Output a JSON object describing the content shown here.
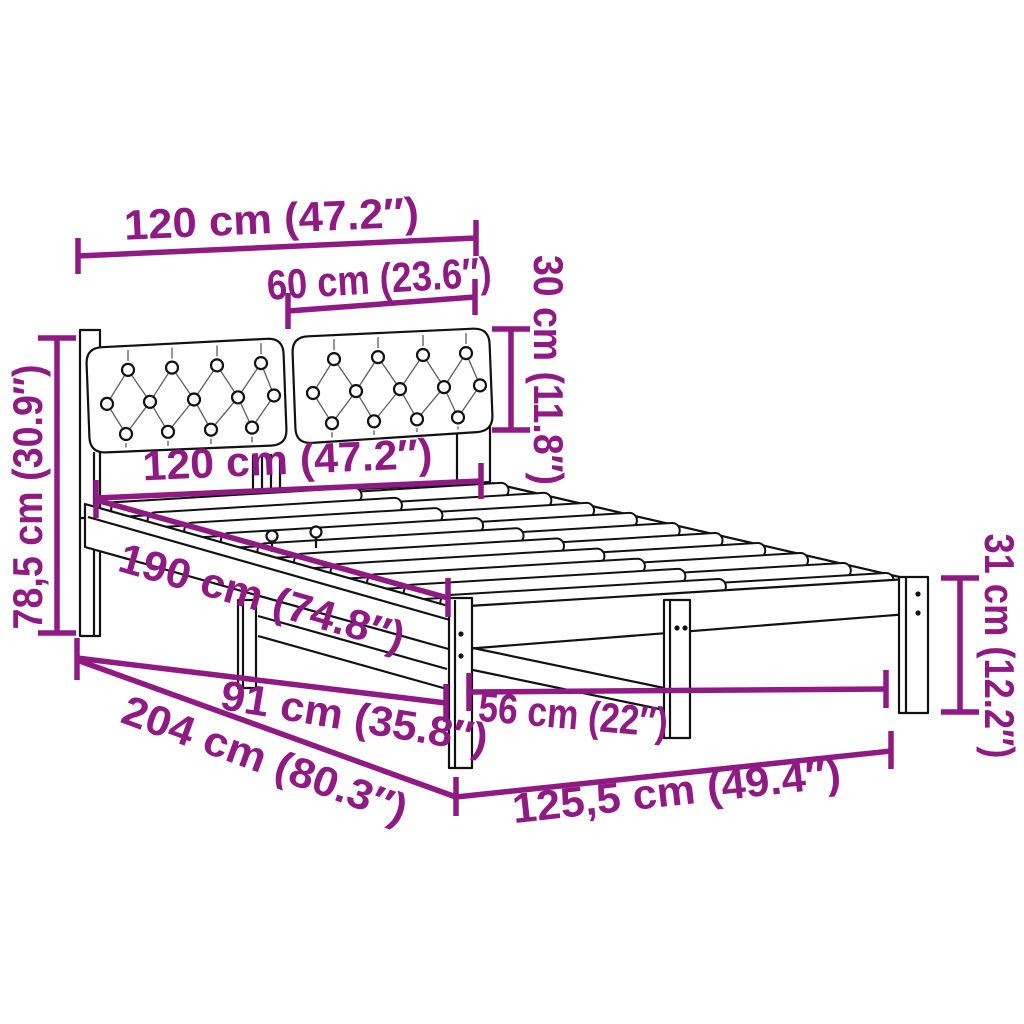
{
  "page": {
    "background": "#ffffff"
  },
  "diagram": {
    "title": "Bed frame with cushioned headboard — dimension diagram",
    "line_color": "#111111",
    "dimension_color": "#8f1a84",
    "slat_count": 10,
    "labels": {
      "headboard_width": "120 cm (47.2″)",
      "cushion_width": "60 cm (23.6″)",
      "cushion_height": "30 cm (11.8″)",
      "headboard_height": "78,5 cm (30.9″)",
      "inner_width": "120 cm (47.2″)",
      "inner_length": "190 cm (74.8″)",
      "support_length": "91 cm (35.8″)",
      "outer_length": "204 cm (80.3″)",
      "leg_span": "56 cm (22″)",
      "outer_width": "125,5 cm (49.4″)",
      "leg_height": "31 cm (12.2″)"
    }
  }
}
